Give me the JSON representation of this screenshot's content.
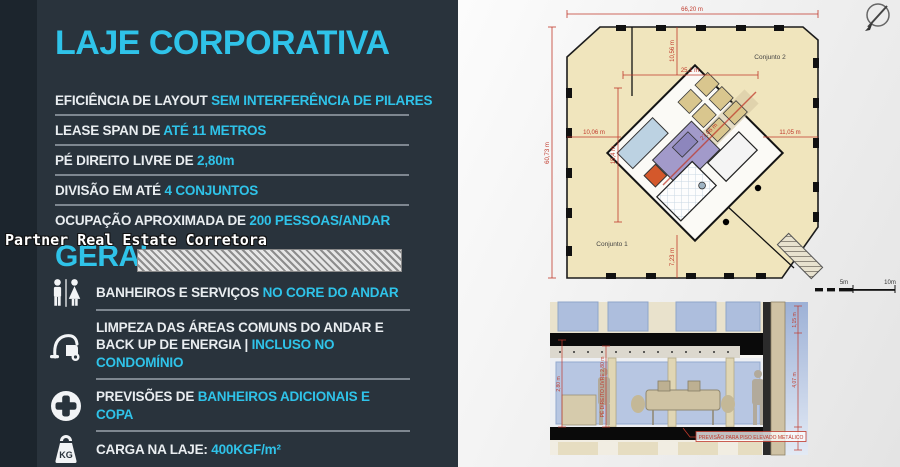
{
  "left_panel": {
    "title": "LAJE CORPORATIVA",
    "specs": [
      {
        "prefix": "EFICIÊNCIA DE LAYOUT ",
        "highlight": "SEM INTERFERÊNCIA DE PILARES"
      },
      {
        "prefix": "LEASE SPAN DE ",
        "highlight": "ATÉ 11 METROS"
      },
      {
        "prefix": "PÉ DIREITO LIVRE DE ",
        "highlight": "2,80m"
      },
      {
        "prefix": "DIVISÃO EM ATÉ ",
        "highlight": "4 CONJUNTOS"
      },
      {
        "prefix": "OCUPAÇÃO APROXIMADA DE ",
        "highlight": "200 PESSOAS/ANDAR"
      }
    ],
    "watermark": "Partner Real Estate Corretora",
    "section_heading": "GERAL",
    "features": [
      {
        "icon": "restroom-icon",
        "prefix": "BANHEIROS E SERVIÇOS ",
        "highlight": "NO CORE DO ANDAR"
      },
      {
        "icon": "vacuum-icon",
        "prefix": "LIMPEZA DAS ÁREAS COMUNS DO ANDAR E BACK UP DE ENERGIA | ",
        "highlight": "INCLUSO NO CONDOMÍNIO"
      },
      {
        "icon": "plus-icon",
        "prefix": "PREVISÕES DE ",
        "highlight": "BANHEIROS ADICIONAIS E COPA"
      },
      {
        "icon": "weight-icon",
        "prefix": "CARGA NA LAJE: ",
        "highlight": "400KGF/m²"
      }
    ],
    "kg_label": "KG",
    "colors": {
      "accent": "#2fc3e9",
      "background": "#29333c",
      "divider": "#7e8790"
    }
  },
  "floor_plan": {
    "conjunto1": "Conjunto 1",
    "conjunto2": "Conjunto 2",
    "dim_total_width": "66,20 m",
    "dim_total_height": "60,73 m",
    "dim_inner_width": "25,1 m",
    "dim_top_offset": "10,56 m",
    "dim_left_offset": "10,06 m",
    "dim_right_offset": "11,05 m",
    "dim_core_height": "15,4 m",
    "dim_bottom_offset": "7,23 m",
    "dim_diagonal": "27,06 m",
    "scale_5": "5m",
    "scale_10": "10m",
    "colors": {
      "floor": "#f0e5bd",
      "dim": "#c0392b",
      "core_purple": "#a29aca",
      "core_blue": "#bcd2e2",
      "core_orange": "#d4582b",
      "elevators": "#d9c68e"
    }
  },
  "section_drawing": {
    "note": "PREVISÃO PARA PISO ELEVADO METÁLICO",
    "dim_left": "2,80 m",
    "dim_long": "PÉ DIREITO LIVRE 2,80 m",
    "dim_right_top": "1,15 m",
    "dim_right_mid": "4,07 m",
    "colors": {
      "sky": "#a9bada",
      "slab": "#0a0a0a",
      "facade": "#cfc2a4"
    }
  }
}
